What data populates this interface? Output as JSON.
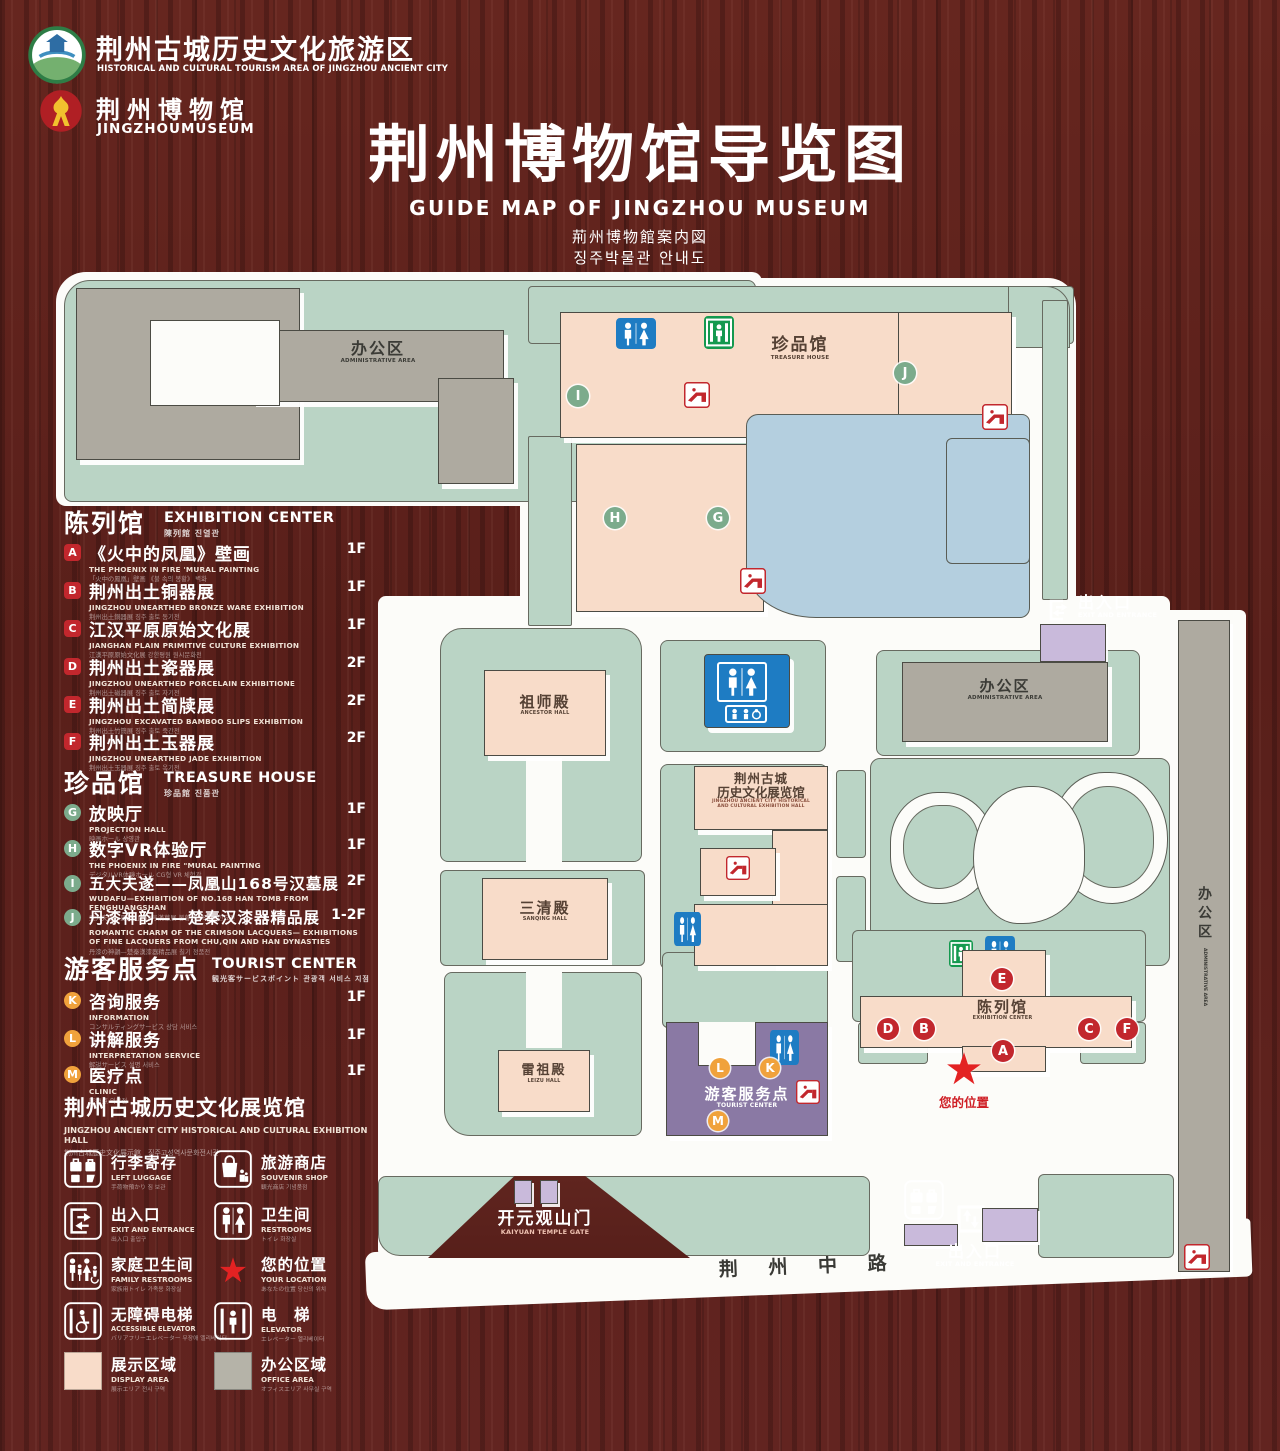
{
  "colors": {
    "wood": "#5e231e",
    "map_green": "#bad4c5",
    "building_pink": "#f8dcc9",
    "building_gray": "#aeaaa0",
    "lake_blue": "#b4cfdf",
    "tourist_purple": "#8a79a4",
    "gate_purple": "#c9badb",
    "marker_red": "#c2272d",
    "marker_green": "#7cab8c",
    "marker_orange": "#f0a23c",
    "icon_blue": "#1e7cc3",
    "icon_green": "#14994f",
    "star_red": "#e32222"
  },
  "header": {
    "tourism_badge": {
      "zh": "荆州古城历史文化旅游区",
      "en": "HISTORICAL AND CULTURAL TOURISM AREA OF JINGZHOU ANCIENT CITY"
    },
    "museum_badge": {
      "zh": "荆州博物馆",
      "en": "JINGZHOUMUSEUM"
    },
    "title": {
      "zh": "荆州博物馆导览图",
      "en": "GUIDE MAP OF JINGZHOU MUSEUM",
      "jp": "荊州博物館案内図",
      "kr": "징주박물관 안내도"
    }
  },
  "legend": {
    "exhibition": {
      "title_zh": "陈列馆",
      "title_en": "EXHIBITION CENTER",
      "title_sub": "陳列館  진열관",
      "items": [
        {
          "key": "A",
          "zh": "《火中的凤凰》壁画",
          "en": "THE PHOENIX IN FIRE 'MURAL PAINTING",
          "sub": "「火中の鳳凰」壁画 《불 속의 봉황》 벽화",
          "floor": "1F"
        },
        {
          "key": "B",
          "zh": "荆州出土铜器展",
          "en": "JINGZHOU UNEARTHED BRONZE WARE EXHIBITION",
          "sub": "荆州出土銅器展  징주 출토 동기전",
          "floor": "1F"
        },
        {
          "key": "C",
          "zh": "江汉平原原始文化展",
          "en": "JIANGHAN PLAIN PRIMITIVE CULTURE EXHIBITION",
          "sub": "江漢平原原始文化展  강한평원 원시문화전",
          "floor": "1F"
        },
        {
          "key": "D",
          "zh": "荆州出土瓷器展",
          "en": "JINGZHOU UNEARTHED PORCELAIN EXHIBITIONE",
          "sub": "荆州出土磁器展  징주 출토 자기전",
          "floor": "2F"
        },
        {
          "key": "E",
          "zh": "荆州出土简牍展",
          "en": "JINGZHOU EXCAVATED BAMBOO SLIPS EXHIBITION",
          "sub": "荆州出土竹簡展  징주 출토 죽간전",
          "floor": "2F"
        },
        {
          "key": "F",
          "zh": "荆州出土玉器展",
          "en": "JINGZHOU UNEARTHED JADE EXHIBITION",
          "sub": "荆州出土玉器展  징주 출토 옥기전",
          "floor": "2F"
        }
      ]
    },
    "treasure": {
      "title_zh": "珍品馆",
      "title_en": "TREASURE HOUSE",
      "title_sub": "珍品館  진품관",
      "items": [
        {
          "key": "G",
          "zh": "放映厅",
          "en": "PROJECTION HALL",
          "sub": "映画ホール  상영관",
          "floor": "1F"
        },
        {
          "key": "H",
          "zh": "数字VR体验厅",
          "en": "THE PHOENIX IN FIRE \"MURAL PAINTING",
          "sub": "デジタルVR体験ホール  CG형 VR 체험관",
          "floor": "1F"
        },
        {
          "key": "I",
          "zh": "五大夫遂——凤凰山168号汉墓展",
          "en": "WUDAFU—EXHIBITION OF NO.168 HAN TOMB FROM FENGHUANGSHAN",
          "sub": "五大夫遂—鳳凰山168号漢墓展  봉황산 168호 한묘전",
          "floor": "2F"
        },
        {
          "key": "J",
          "zh": "丹漆神韵——楚秦汉漆器精品展",
          "en": "ROMANTIC CHARM OF THE CRIMSON LACQUERS— EXHIBITIONS OF FINE LACQUERS FROM CHU,QIN AND HAN DYNASTIES",
          "sub": "丹漆の神韻—楚秦漢漆器精品展  칠기 정품전",
          "floor": "1-2F"
        }
      ]
    },
    "tourist": {
      "title_zh": "游客服务点",
      "title_en": "TOURIST CENTER",
      "title_sub": "観光客サービスポイント  관광객 서비스 지점",
      "items": [
        {
          "key": "K",
          "zh": "咨询服务",
          "en": "INFORMATION",
          "sub": "コンサルティングサービス  상담 서비스",
          "floor": "1F"
        },
        {
          "key": "L",
          "zh": "讲解服务",
          "en": "INTERPRETATION SERVICE",
          "sub": "解説サービス  설명 서비스",
          "floor": "1F"
        },
        {
          "key": "M",
          "zh": "医疗点",
          "en": "CLINIC",
          "sub": "医療点  의료점",
          "floor": "1F"
        }
      ]
    },
    "hall_banner": {
      "zh": "荆州古城历史文化展览馆",
      "en": "JINGZHOU ANCIENT CITY HISTORICAL AND CULTURAL EXHIBITION HALL",
      "sub": "荆州古城歴史文化展示館　징주고성역사문화전시관"
    },
    "symbols": {
      "items": [
        {
          "icon": "left-luggage-icon",
          "zh": "行李寄存",
          "en": "LEFT LUGGAGE",
          "sub": "手荷物預かり  짐 보관"
        },
        {
          "icon": "souvenir-shop-icon",
          "zh": "旅游商店",
          "en": "SOUVENIR SHOP",
          "sub": "観光商店  기념품점"
        },
        {
          "icon": "exit-entrance-icon",
          "zh": "出入口",
          "en": "EXIT AND ENTRANCE",
          "sub": "出入口  출입구"
        },
        {
          "icon": "restrooms-icon",
          "zh": "卫生间",
          "en": "RESTROOMS",
          "sub": "トイレ  화장실"
        },
        {
          "icon": "family-restrooms-icon",
          "zh": "家庭卫生间",
          "en": "FAMILY RESTROOMS",
          "sub": "家族用トイレ  가족용 화장실"
        },
        {
          "icon": "your-location-star",
          "zh": "您的位置",
          "en": "YOUR LOCATION",
          "sub": "あなたの位置  당신의 위치"
        },
        {
          "icon": "accessible-elevator-icon",
          "zh": "无障碍电梯",
          "en": "ACCESSIBLE ELEVATOR",
          "sub": "バリアフリーエレベーター  무장애 엘리베이터"
        },
        {
          "icon": "elevator-icon",
          "zh": "电　梯",
          "en": "ELEVATOR",
          "sub": "エレベーター  엘리베이터"
        },
        {
          "icon": "display-area-swatch",
          "zh": "展示区域",
          "en": "DISPLAY AREA",
          "sub": "展示エリア  전시 구역"
        },
        {
          "icon": "office-area-swatch",
          "zh": "办公区域",
          "en": "OFFICE AREA",
          "sub": "オフィスエリア  사무실 구역"
        }
      ]
    }
  },
  "map": {
    "office_top": {
      "zh": "办公区",
      "en": "ADMINISTRATIVE AREA"
    },
    "treasure": {
      "zh": "珍品馆",
      "en": "TREASURE HOUSE"
    },
    "exit_top": {
      "zh": "出入口",
      "en": "EXIT AND ENTRANCE"
    },
    "office_right": {
      "zh": "办公区",
      "en": "ADMINISTRATIVE AREA"
    },
    "office_strip": {
      "zh": "办公区",
      "en": "ADMINISTRATIVE AREA"
    },
    "ancestor": {
      "zh": "祖师殿",
      "en": "ANCESTOR HALL"
    },
    "sanqing": {
      "zh": "三清殿",
      "en": "SANQING HALL"
    },
    "leizu": {
      "zh": "雷祖殿",
      "en": "LEIZU HALL"
    },
    "exhibition_hall": {
      "zh1": "荆州古城",
      "zh2": "历史文化展览馆",
      "en1": "JINGZHOU ANCIENT CITY HISTORICAL",
      "en2": "AND CULTURAL EXHIBITION HALL"
    },
    "tourist": {
      "zh": "游客服务点",
      "en": "TOURIST CENTER"
    },
    "exhibition_center": {
      "zh": "陈列馆",
      "en": "EXHIBITION CENTER"
    },
    "your_location": {
      "zh": "您的位置"
    },
    "gate": {
      "zh": "开元观山门",
      "en": "KAIYUAN TEMPLE GATE"
    },
    "exit_bottom": {
      "zh": "出入口",
      "en": "EXIT AND ENTRANCE"
    },
    "road": {
      "zh": "荆 州 中 路"
    },
    "markers": {
      "treasure": [
        "I",
        "H",
        "G",
        "J"
      ],
      "exhibition": [
        "E",
        "D",
        "B",
        "C",
        "F",
        "A"
      ],
      "tourist": [
        "L",
        "K",
        "M"
      ]
    }
  }
}
